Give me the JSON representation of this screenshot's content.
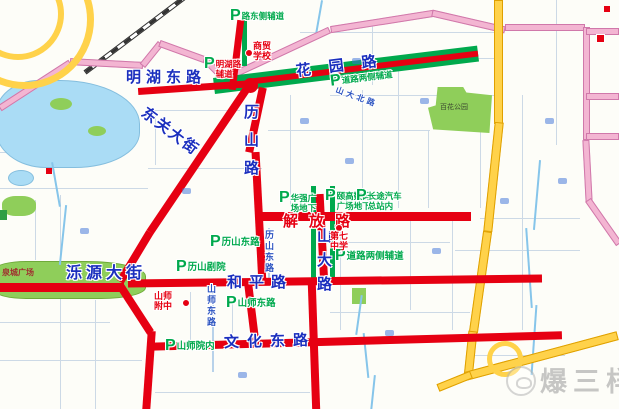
{
  "watermark": {
    "text": "爆三样"
  },
  "roads": {
    "minghu": "明湖东路",
    "dongguan": "东关大街",
    "lishan": "历山路",
    "huayuan": "花园路",
    "jiefang": "解放路",
    "shanda": "山大路",
    "heping": "和平路",
    "luoyuan": "泺源大街",
    "wenhua": "文化东路"
  },
  "small_streets": {
    "lishandong": "历山东路",
    "shanshidong": "山师东路",
    "shandabei": "山大北路"
  },
  "areas": {
    "quancheng_square": "泉城广场",
    "baihua_park": "百花公园"
  },
  "pois": [
    {
      "lines": [
        "商贸",
        "学校"
      ]
    },
    {
      "lines": [
        "第七",
        "中学"
      ]
    },
    {
      "lines": [
        "山师",
        "附中"
      ]
    }
  ],
  "parking": [
    {
      "p": "P",
      "lines": [
        "路东侧辅道"
      ]
    },
    {
      "p": "P",
      "lines": [
        "明湖路",
        "辅道"
      ]
    },
    {
      "p": "P",
      "lines": [
        "道路两侧辅道"
      ]
    },
    {
      "p": "P",
      "lines": [
        "华强广",
        "场地下"
      ]
    },
    {
      "p": "P",
      "lines": [
        "颐高数码",
        "广场地下"
      ]
    },
    {
      "p": "P",
      "lines": [
        "长途汽车",
        "总站内"
      ]
    },
    {
      "p": "P",
      "lines": [
        "历山东路"
      ]
    },
    {
      "p": "P",
      "lines": [
        "历山剧院"
      ]
    },
    {
      "p": "P",
      "lines": [
        "道路两侧辅道"
      ]
    },
    {
      "p": "P",
      "lines": [
        "山师东路"
      ]
    },
    {
      "p": "P",
      "lines": [
        "山师院内"
      ]
    }
  ],
  "colors": {
    "highlight_road_red": "#e60012",
    "parking_green": "#00a94d",
    "road_label_blue": "#1b2fbe",
    "ring_road_pink": "#f3b5d2",
    "expressway_yellow": "#ffd24a",
    "park_green": "#8fce5a",
    "water_blue": "#aadcf5"
  }
}
